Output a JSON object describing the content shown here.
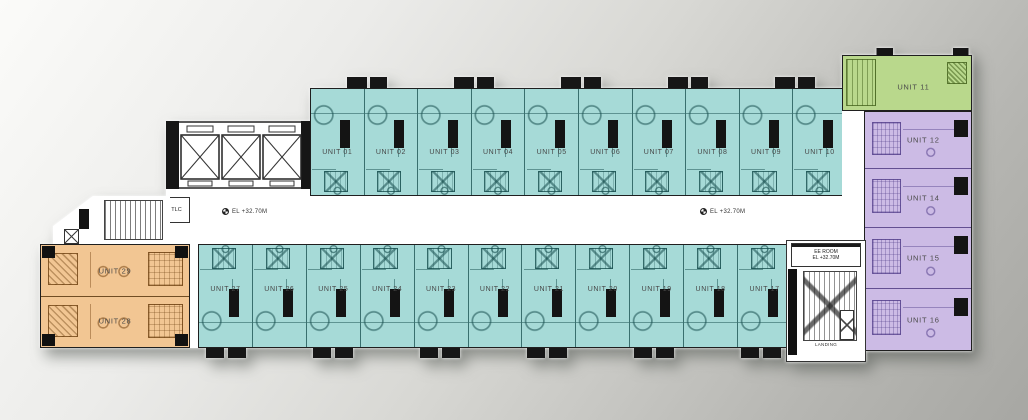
{
  "colors": {
    "teal": "#a6dad7",
    "orange": "#f2c693",
    "green": "#b9d88c",
    "purple": "#ccbbe5"
  },
  "corridor": {
    "elevation_left": "EL +32.70M",
    "elevation_right": "EL +32.70M"
  },
  "rooms": {
    "tlc": "TLC",
    "ee_room": "EE ROOM",
    "ee_room_elevation": "EL +32.70M",
    "landing": "LANDING"
  },
  "units_top": [
    {
      "label": "UNIT 01"
    },
    {
      "label": "UNIT 02"
    },
    {
      "label": "UNIT 03"
    },
    {
      "label": "UNIT 04"
    },
    {
      "label": "UNIT 05"
    },
    {
      "label": "UNIT 06"
    },
    {
      "label": "UNIT 07"
    },
    {
      "label": "UNIT 08"
    },
    {
      "label": "UNIT 09"
    },
    {
      "label": "UNIT 10"
    }
  ],
  "units_bottom": [
    {
      "label": "UNIT 27"
    },
    {
      "label": "UNIT 26"
    },
    {
      "label": "UNIT 25"
    },
    {
      "label": "UNIT 24"
    },
    {
      "label": "UNIT 23"
    },
    {
      "label": "UNIT 22"
    },
    {
      "label": "UNIT 21"
    },
    {
      "label": "UNIT 20"
    },
    {
      "label": "UNIT 19"
    },
    {
      "label": "UNIT 18"
    },
    {
      "label": "UNIT 17"
    }
  ],
  "units_left": [
    {
      "label": "UNIT 29"
    },
    {
      "label": "UNIT 28"
    }
  ],
  "unit_green": {
    "label": "UNIT 11"
  },
  "units_right": [
    {
      "label": "UNIT 12"
    },
    {
      "label": "UNIT 14"
    },
    {
      "label": "UNIT 15"
    },
    {
      "label": "UNIT 16"
    }
  ]
}
